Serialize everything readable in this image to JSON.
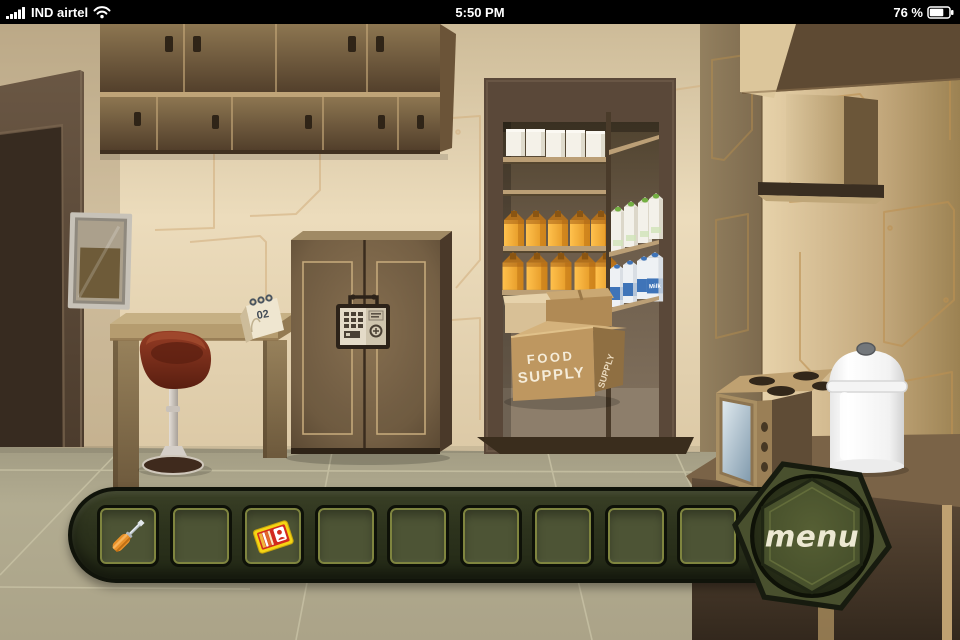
{
  "status_bar": {
    "carrier": "IND airtel",
    "time": "5:50 PM",
    "battery": "76 %"
  },
  "icons": {
    "signal-icon": "five ascending white bars",
    "wifi-icon": "three arcs with dot",
    "battery-icon": "rounded rect ~76% filled",
    "screwdriver-icon": "orange-handled screwdriver, tip up-right",
    "id-card-icon": "yellow-bordered red ID card with white person badge",
    "menu-button": "olive hex-bolt button"
  },
  "scene": {
    "pantry": {
      "box_front_line1": "FOOD",
      "box_front_line2": "SUPPLY",
      "box_side_text": "SUPPLY",
      "milk_label": "Milk"
    },
    "desk_calendar_number": "02"
  },
  "inventory": {
    "menu_label": "MENU",
    "slots": [
      "screwdriver",
      "",
      "id-card",
      "",
      "",
      "",
      "",
      "",
      ""
    ]
  },
  "colors": {
    "inventory_olive": "#30351f",
    "slot_inner_stroke": "#7f853f",
    "wall_beige": "#e6d6b8",
    "wood_brown": "#7b654a",
    "carton_orange": "#f0a22e",
    "milk_blue": "#3f74b8",
    "stool_red": "#7e2c18",
    "screwdriver_orange": "#e8912a",
    "card_yellow": "#f5d514",
    "card_red": "#d22a1e"
  }
}
